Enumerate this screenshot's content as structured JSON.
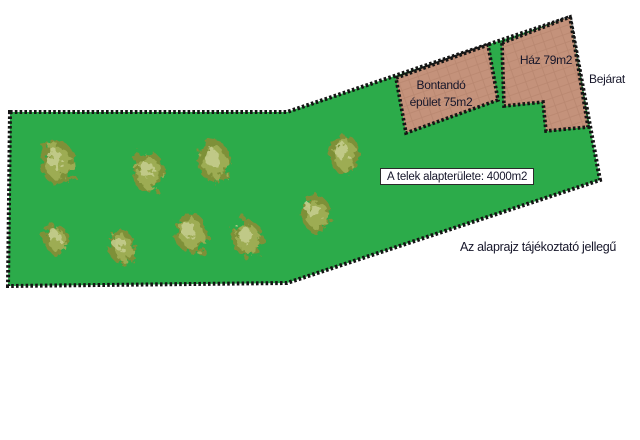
{
  "colors": {
    "background": "#ffffff",
    "plot_green": "#2cab4a",
    "border": "#141414",
    "building_fill": "#c4927b",
    "building_grid": "#ad7c66",
    "tree_dark": "#7e9038",
    "tree_mid": "#9fae54",
    "tree_light": "#c9d194",
    "text": "#16162a"
  },
  "labels": {
    "demolish_line1": "Bontandó",
    "demolish_line2": "épület 75m2",
    "house": "Ház 79m2",
    "entrance": "Bejárat",
    "plot_area": "A telek alapterülete: 4000m2",
    "disclaimer": "Az alaprajz tájékoztató jellegű"
  },
  "trees": [
    {
      "x": 57,
      "y": 162,
      "rx": 17,
      "ry": 22
    },
    {
      "x": 148,
      "y": 172,
      "rx": 16,
      "ry": 21
    },
    {
      "x": 214,
      "y": 161,
      "rx": 16,
      "ry": 21
    },
    {
      "x": 344,
      "y": 154,
      "rx": 15,
      "ry": 20
    },
    {
      "x": 56,
      "y": 239,
      "rx": 12,
      "ry": 15
    },
    {
      "x": 122,
      "y": 247,
      "rx": 13,
      "ry": 17
    },
    {
      "x": 191,
      "y": 233,
      "rx": 16,
      "ry": 20
    },
    {
      "x": 247,
      "y": 238,
      "rx": 15,
      "ry": 19
    },
    {
      "x": 316,
      "y": 214,
      "rx": 14,
      "ry": 19
    }
  ]
}
